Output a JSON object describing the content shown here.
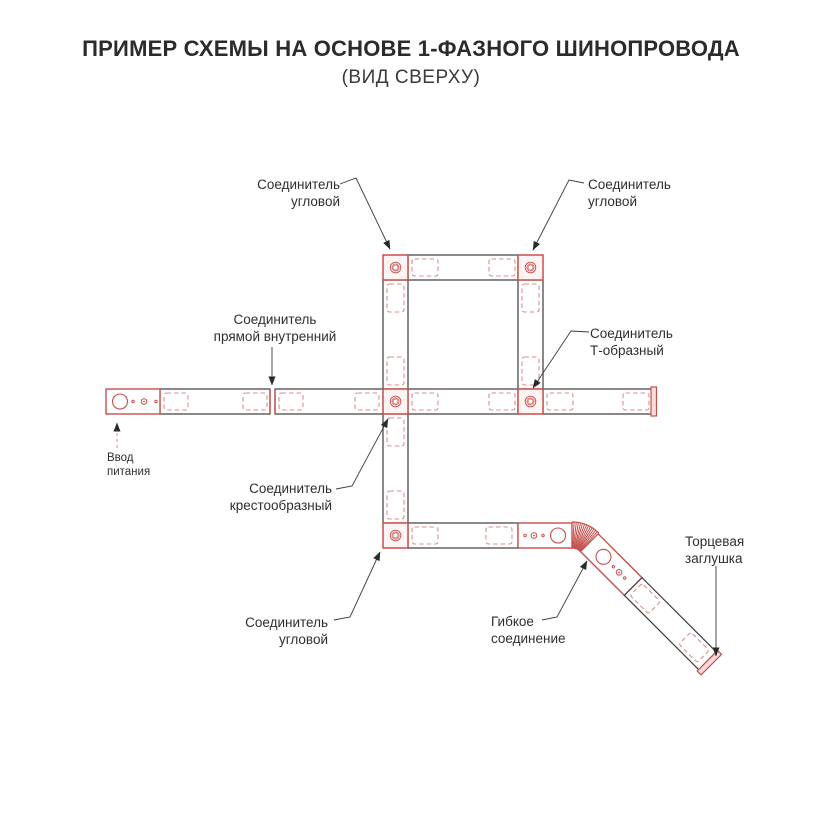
{
  "title": "ПРИМЕР СХЕМЫ НА ОСНОВЕ 1-ФАЗНОГО ШИНОПРОВОДА",
  "subtitle": "(ВИД СВЕРХУ)",
  "labels": {
    "corner_top_left": {
      "line1": "Соединитель",
      "line2": "угловой"
    },
    "corner_top_right": {
      "line1": "Соединитель",
      "line2": "угловой"
    },
    "straight_internal": {
      "line1": "Соединитель",
      "line2": "прямой внутренний"
    },
    "t_shaped": {
      "line1": "Соединитель",
      "line2": "Т-образный"
    },
    "cross": {
      "line1": "Соединитель",
      "line2": "крестообразный"
    },
    "corner_bottom": {
      "line1": "Соединитель",
      "line2": "угловой"
    },
    "flexible": {
      "line1": "Гибкое",
      "line2": "соединение"
    },
    "end_cap": {
      "line1": "Торцевая",
      "line2": "заглушка"
    },
    "power_input": {
      "line1": "Ввод",
      "line2": "питания"
    }
  },
  "colors": {
    "accent_red": "#c5514e",
    "dashed_pink": "#db8e8b",
    "line_black": "#3b3b3b",
    "background": "#ffffff"
  }
}
